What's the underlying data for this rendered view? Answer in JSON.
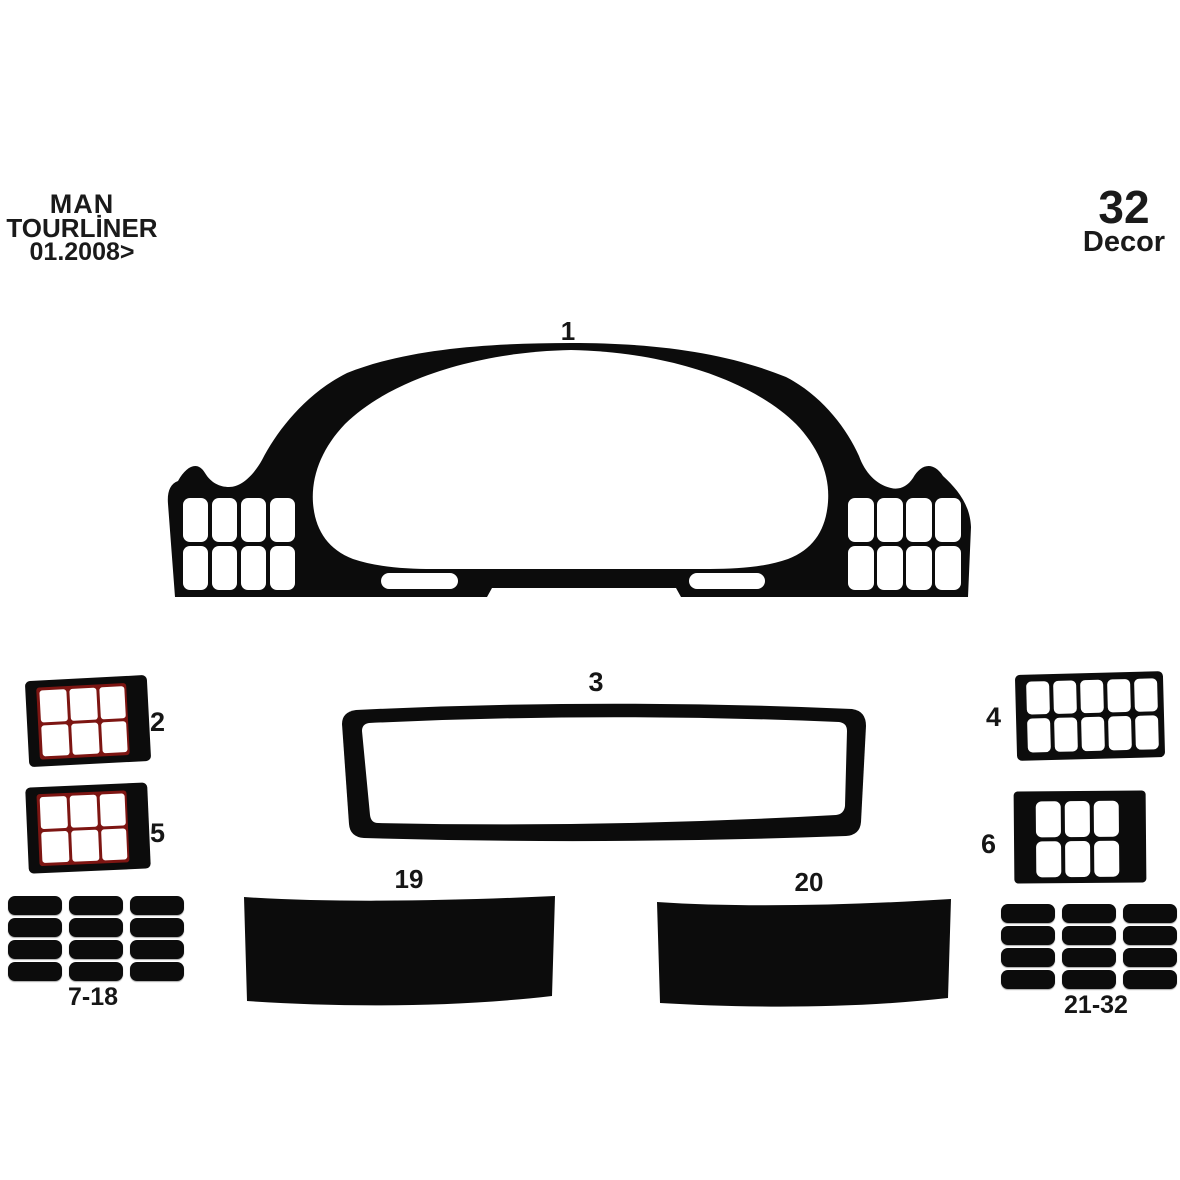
{
  "header": {
    "brand_line1": "MAN",
    "brand_line2": "TOURLİNER",
    "brand_line3": "01.2008>"
  },
  "badge": {
    "count": "32",
    "label": "Decor"
  },
  "pieces": {
    "p1": {
      "label": "1",
      "description": "instrument cluster bezel with two 4x2 button grids and two bottom slots"
    },
    "p2": {
      "label": "2",
      "description": "switch panel frame, 3x2 cells with red dividers"
    },
    "p3": {
      "label": "3",
      "description": "wide center console frame outline"
    },
    "p4": {
      "label": "4",
      "description": "switch panel frame, 5x2 cells"
    },
    "p5": {
      "label": "5",
      "description": "switch panel frame, 3x2 cells with red dividers"
    },
    "p6": {
      "label": "6",
      "description": "switch panel frame, 3x2 cells"
    },
    "p7_18": {
      "label": "7-18",
      "description": "12 blank trim buttons, 3x4 grid"
    },
    "p19": {
      "label": "19",
      "description": "solid trim panel left"
    },
    "p20": {
      "label": "20",
      "description": "solid trim panel right"
    },
    "p21_32": {
      "label": "21-32",
      "description": "12 blank trim buttons, 3x4 grid"
    }
  },
  "colors": {
    "ink": "#0c0c0c",
    "background": "#ffffff",
    "red_grid_line": "#7d1512"
  }
}
